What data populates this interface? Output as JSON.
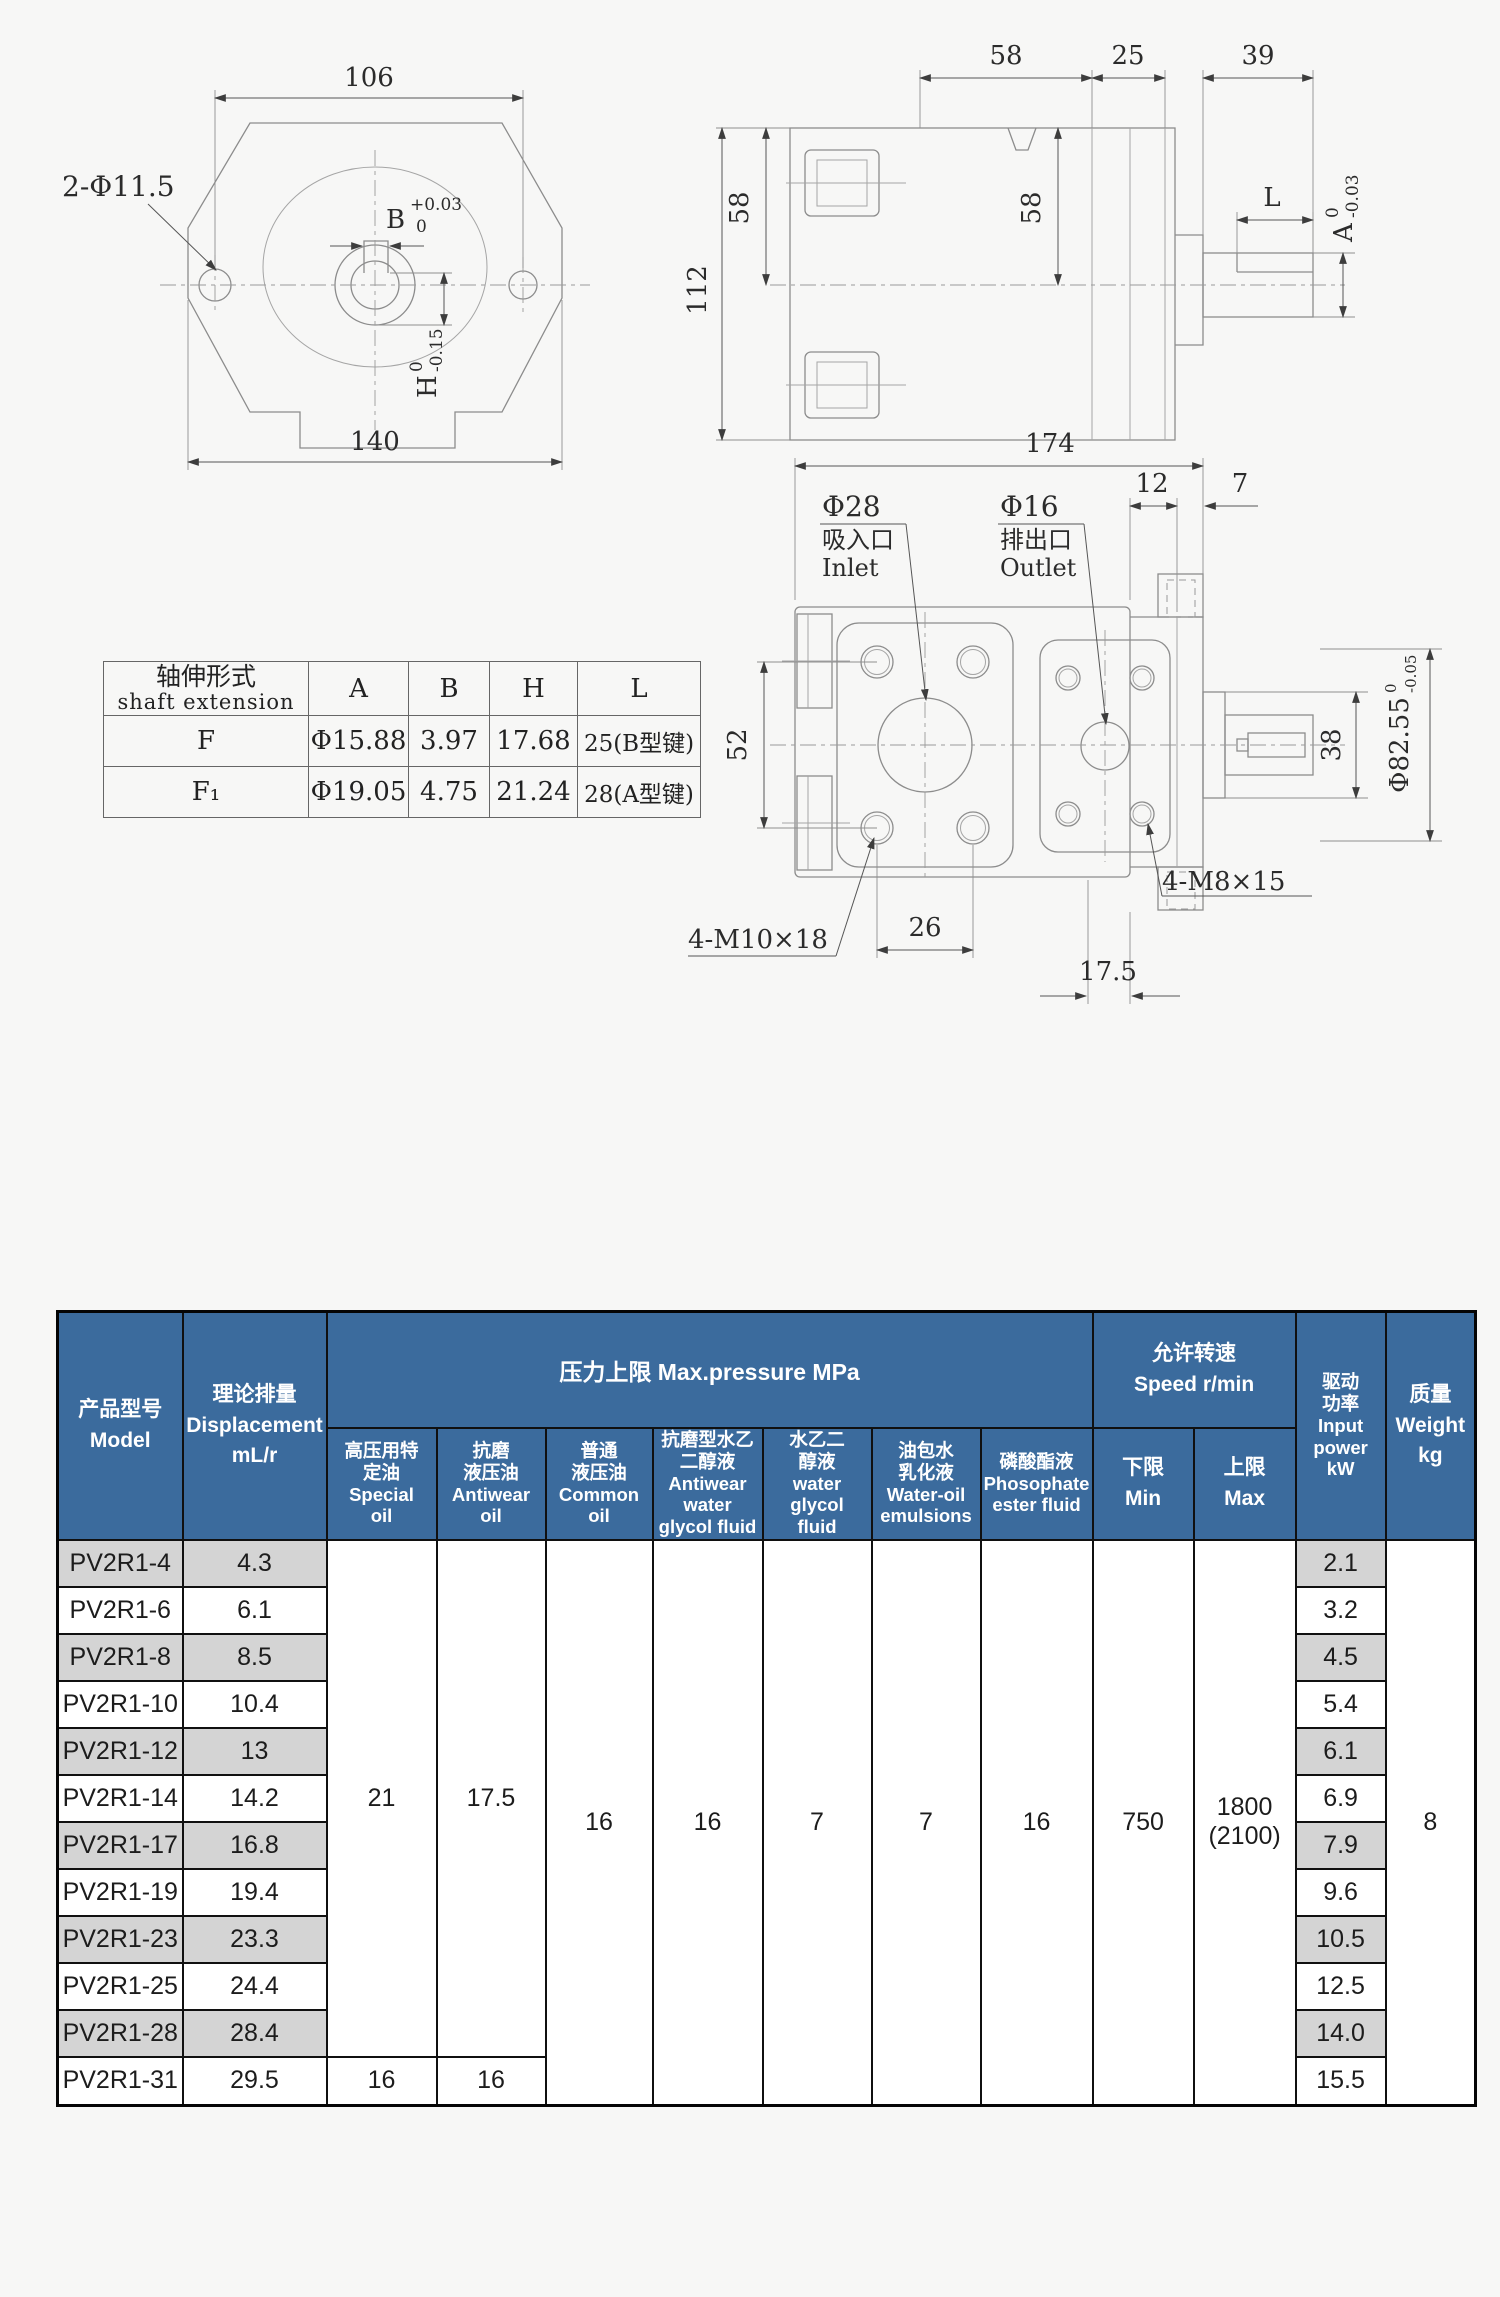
{
  "drawings": {
    "front": {
      "dim_top": "106",
      "dim_bottom": "140",
      "holes_label": "2-Φ11.5",
      "dim_b": "B",
      "dim_b_tol_top": "+0.03",
      "dim_b_tol_bottom": "0",
      "dim_h": "H",
      "dim_h_tol_top": "0",
      "dim_h_tol_bottom": "-0.15"
    },
    "side": {
      "dim_58_top": "58",
      "dim_25": "25",
      "dim_39": "39",
      "dim_112": "112",
      "dim_58_left": "58",
      "dim_58_right": "58",
      "dim_l": "L",
      "dim_a": "A",
      "dim_a_tol_top": "0",
      "dim_a_tol_bottom": "-0.03"
    },
    "bottom": {
      "dim_174": "174",
      "dim_12": "12",
      "dim_7": "7",
      "inlet_dia": "Φ28",
      "inlet_cn": "吸入口",
      "inlet_en": "Inlet",
      "outlet_dia": "Φ16",
      "outlet_cn": "排出口",
      "outlet_en": "Outlet",
      "dim_52": "52",
      "dim_38": "38",
      "dim_spigot": "Φ82.55",
      "dim_spigot_tol_top": "0",
      "dim_spigot_tol_bottom": "-0.05",
      "bolt_left": "4-M10×18",
      "dim_26": "26",
      "dim_175": "17.5",
      "bolt_right": "4-M8×15"
    }
  },
  "shaft_table": {
    "title_cn": "轴伸形式",
    "title_en": "shaft extension",
    "col_a": "A",
    "col_b": "B",
    "col_h": "H",
    "col_l": "L",
    "rows": [
      {
        "type": "F",
        "a": "Φ15.88",
        "b": "3.97",
        "h": "17.68",
        "l": "25(B型键)"
      },
      {
        "type": "F₁",
        "a": "Φ19.05",
        "b": "4.75",
        "h": "21.24",
        "l": "28(A型键)"
      }
    ]
  },
  "spec_table": {
    "colors": {
      "header_bg": "#3b6b9d",
      "row_alt_bg": "#d4d4d4"
    },
    "headers": {
      "model": "产品型号\nModel",
      "displacement": "理论排量\nDisplacement\nmL/r",
      "pressure_banner": "压力上限 Max.pressure MPa",
      "special_oil": "高压用特\n定油\nSpecial\noil",
      "antiwear_oil": "抗磨\n液压油\nAntiwear\noil",
      "common_oil": "普通\n液压油\nCommon\noil",
      "antiwear_glycol": "抗磨型水乙\n二醇液\nAntiwear\nwater\nglycol fluid",
      "water_glycol": "水乙二\n醇液\nwater\nglycol\nfluid",
      "water_oil": "油包水\n乳化液\nWater-oil\nemulsions",
      "phosphate": "磷酸酯液\nPhosophate\nester fluid",
      "speed_banner": "允许转速\nSpeed r/min",
      "speed_min": "下限\nMin",
      "speed_max": "上限\nMax",
      "power": "驱动\n功率\nInput\npower\nkW",
      "weight": "质量\nWeight\nkg"
    },
    "merged": {
      "special_oil_main": "21",
      "antiwear_oil_main": "17.5",
      "special_oil_last": "16",
      "antiwear_oil_last": "16",
      "common_oil": "16",
      "antiwear_glycol": "16",
      "water_glycol": "7",
      "water_oil": "7",
      "phosphate": "16",
      "speed_min": "750",
      "speed_max": "1800\n(2100)",
      "weight": "8"
    },
    "rows": [
      {
        "model": "PV2R1-4",
        "displacement": "4.3",
        "power": "2.1"
      },
      {
        "model": "PV2R1-6",
        "displacement": "6.1",
        "power": "3.2"
      },
      {
        "model": "PV2R1-8",
        "displacement": "8.5",
        "power": "4.5"
      },
      {
        "model": "PV2R1-10",
        "displacement": "10.4",
        "power": "5.4"
      },
      {
        "model": "PV2R1-12",
        "displacement": "13",
        "power": "6.1"
      },
      {
        "model": "PV2R1-14",
        "displacement": "14.2",
        "power": "6.9"
      },
      {
        "model": "PV2R1-17",
        "displacement": "16.8",
        "power": "7.9"
      },
      {
        "model": "PV2R1-19",
        "displacement": "19.4",
        "power": "9.6"
      },
      {
        "model": "PV2R1-23",
        "displacement": "23.3",
        "power": "10.5"
      },
      {
        "model": "PV2R1-25",
        "displacement": "24.4",
        "power": "12.5"
      },
      {
        "model": "PV2R1-28",
        "displacement": "28.4",
        "power": "14.0"
      },
      {
        "model": "PV2R1-31",
        "displacement": "29.5",
        "power": "15.5"
      }
    ]
  }
}
